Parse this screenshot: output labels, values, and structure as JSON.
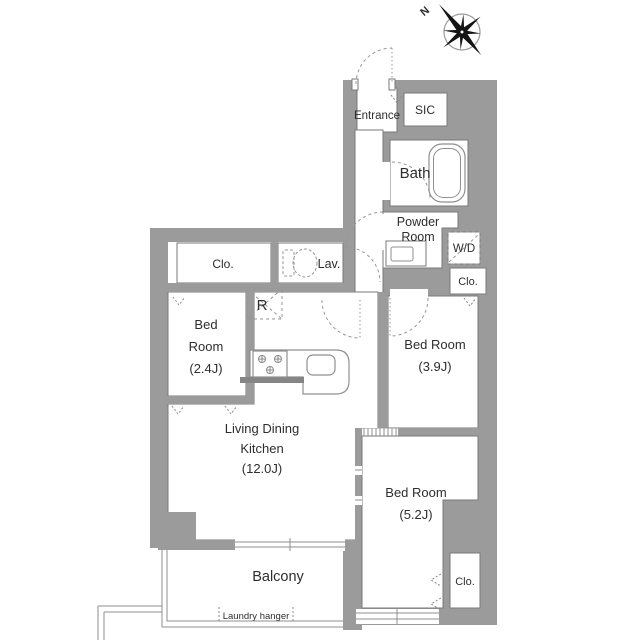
{
  "plan_title": "apartment-floor-plan",
  "compass": {
    "north_label": "N"
  },
  "rooms": {
    "entrance": {
      "label": "Entrance"
    },
    "sic": {
      "label": "SIC"
    },
    "bath": {
      "label": "Bath"
    },
    "powder_room": {
      "line1": "Powder",
      "line2": "Room"
    },
    "washer_dryer": {
      "label": "W/D"
    },
    "closet_bedroom_39": {
      "label": "Clo."
    },
    "closet_hall": {
      "label": "Clo."
    },
    "lavatory": {
      "label": "Lav."
    },
    "refrigerator": {
      "label": "R"
    },
    "bedroom_24": {
      "line1": "Bed",
      "line2": "Room",
      "line3": "(2.4J)"
    },
    "bedroom_39": {
      "line1": "Bed Room",
      "line2": "(3.9J)"
    },
    "living_dining_kitchen": {
      "line1": "Living Dining",
      "line2": "Kitchen",
      "line3": "(12.0J)"
    },
    "bedroom_52": {
      "line1": "Bed Room",
      "line2": "(5.2J)"
    },
    "closet_bedroom_52": {
      "label": "Clo."
    },
    "balcony": {
      "label": "Balcony"
    },
    "laundry_hanger": {
      "label": "Laundry hanger"
    }
  },
  "colors": {
    "wall": "#9b9b9b",
    "counter_wall": "#858585",
    "outline": "#7a7a7a",
    "dash": "#979797",
    "text": "#2e2e2e",
    "background": "#ffffff"
  }
}
